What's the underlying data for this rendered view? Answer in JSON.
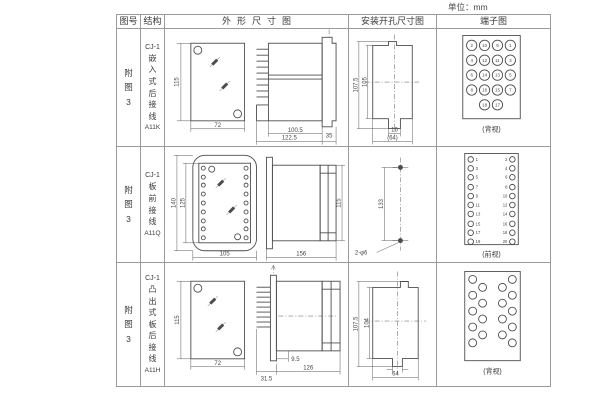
{
  "unit_label": "单位：mm",
  "header": {
    "figure": "图号",
    "structure": "结构",
    "outline": "外形尺寸图",
    "mounting": "安装开孔尺寸图",
    "terminal": "端子图"
  },
  "rows": [
    {
      "figure": "附图3",
      "model": "CJ-1",
      "structure": "嵌入式后接线",
      "code": "A11K",
      "outline": {
        "front_height": "115",
        "front_width": "72",
        "depth_body": "100.5",
        "depth_total": "122.5",
        "flange": "35"
      },
      "mounting": {
        "outer_height": "107.5",
        "inner_height": "105",
        "slot_width": "16",
        "width": "(64)"
      },
      "terminal": {
        "caption": "(背视)",
        "numbers": [
          "2",
          "10",
          "9",
          "1",
          "4",
          "12",
          "11",
          "3",
          "6",
          "14",
          "13",
          "5",
          "8",
          "16",
          "15",
          "7",
          "18",
          "17"
        ]
      }
    },
    {
      "figure": "附图3",
      "model": "CJ-1",
      "structure": "板前接线",
      "code": "A11Q",
      "outline": {
        "outer_height": "140",
        "inner_height": "125",
        "front_width": "105",
        "depth": "156",
        "side_height": "115"
      },
      "mounting": {
        "hole_pitch": "133",
        "holes": "2-φ6"
      },
      "terminal": {
        "caption": "(前视)",
        "left_numbers": [
          "1",
          "3",
          "5",
          "7",
          "9",
          "11",
          "13",
          "15",
          "17",
          "19"
        ],
        "right_numbers": [
          "2",
          "4",
          "6",
          "8",
          "10",
          "12",
          "14",
          "16",
          "18",
          "20"
        ]
      }
    },
    {
      "figure": "附图3",
      "model": "CJ-1",
      "structure": "凸出式板后接线",
      "code": "A11H",
      "outline": {
        "front_height": "115",
        "front_width": "72",
        "pin_depth": "31.5",
        "offset": "9.5",
        "depth_total": "126"
      },
      "mounting": {
        "outer_height": "107.5",
        "inner_height": "104",
        "width": "64"
      },
      "terminal": {
        "caption": "(背视)"
      }
    }
  ]
}
